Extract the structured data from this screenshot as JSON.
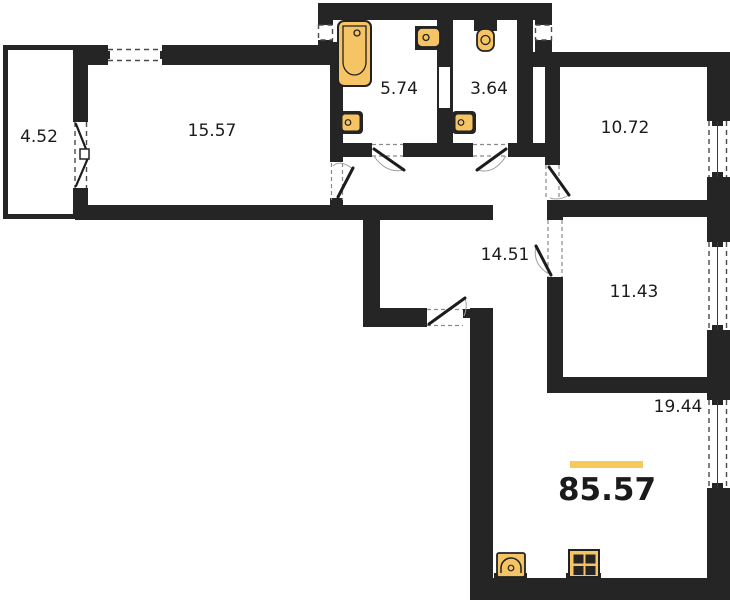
{
  "floorplan": {
    "total_area_label": "85.57",
    "rooms": [
      {
        "name": "balcony",
        "area": "4.52"
      },
      {
        "name": "living-room",
        "area": "15.57"
      },
      {
        "name": "bathroom",
        "area": "5.74"
      },
      {
        "name": "toilet",
        "area": "3.64"
      },
      {
        "name": "bedroom",
        "area": "10.72"
      },
      {
        "name": "hallway",
        "area": "14.51"
      },
      {
        "name": "bedroom-2",
        "area": "11.43"
      },
      {
        "name": "kitchen-living-room",
        "area": "19.44"
      }
    ],
    "colors": {
      "wall": "#252525",
      "fixture_fill": "#F5C464",
      "fixture_outline": "#222222",
      "accent_bar": "#F6C95B",
      "label_text": "#1b1b1b"
    }
  }
}
